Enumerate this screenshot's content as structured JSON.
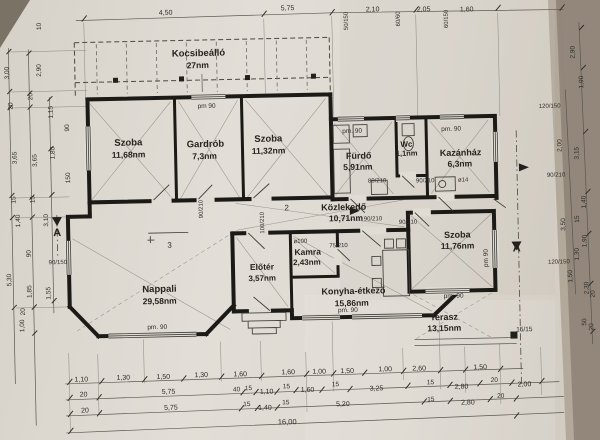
{
  "drawing_title": "floor plan photo",
  "rooms": [
    {
      "name": "Kocsibeálló",
      "area": "27nm"
    },
    {
      "name": "Szoba",
      "area": "11,68nm"
    },
    {
      "name": "Gardrób",
      "area": "7,3nm"
    },
    {
      "name": "Szoba",
      "area": "11,32nm"
    },
    {
      "name": "Fürdő",
      "area": "5,91nm"
    },
    {
      "name": "Wc",
      "area": "1,1nm"
    },
    {
      "name": "Kazánház",
      "area": "6,3nm"
    },
    {
      "name": "Közlekedő",
      "area": "10,71nm"
    },
    {
      "name": "Kamra",
      "area": "2,43nm"
    },
    {
      "name": "Előtér",
      "area": "3,57nm"
    },
    {
      "name": "Nappali",
      "area": "29,58nm"
    },
    {
      "name": "Konyha-étkező",
      "area": "15,86nm"
    },
    {
      "name": "Szoba",
      "area": "11,76nm"
    },
    {
      "name": "Terasz",
      "area": "13,15nm"
    }
  ],
  "dims": {
    "top": [
      "4,50",
      "5,75",
      "2,10",
      "2,05",
      "1,60"
    ],
    "top_window_specs": [
      "50/150",
      "60/60",
      "60/150"
    ],
    "bottom_row1": [
      "1,10",
      "1,30",
      "1,50",
      "1,30",
      "1,60",
      "1,60",
      "1,00",
      "1,50",
      "1,00",
      "2,60",
      "1,50"
    ],
    "bottom_row2": [
      "20",
      "5,75",
      "40",
      "15",
      "1,10",
      "15",
      "1,60",
      "15",
      "3,25",
      "15",
      "2,80",
      "20",
      "2,00"
    ],
    "bottom_row3": [
      "20",
      "5,75",
      "15",
      "1,40",
      "15",
      "5,20",
      "15",
      "2,80",
      "20"
    ],
    "bottom_total": "16,00",
    "left": [
      "10",
      "3,00",
      "2,90",
      "20",
      "20",
      "1,15",
      "90",
      "3,65",
      "3,65",
      "1,80",
      "150",
      "15",
      "15",
      "1,40",
      "3,10",
      "90",
      "90/150",
      "5,30",
      "1,85",
      "1,55",
      "20",
      "1,00"
    ],
    "right": [
      "2,90",
      "1,90",
      "120/150",
      "2,00",
      "3,15",
      "90/210",
      "1,40",
      "15",
      "3,50",
      "1,90",
      "1,30",
      "120/150",
      "1,50",
      "2,30",
      "20",
      "50",
      "20"
    ]
  },
  "labels": [
    {
      "t": "Kocsibeálló",
      "x": 202,
      "y": 54,
      "s": 9.5,
      "b": 1,
      "n": "room-name-kocsibeallo"
    },
    {
      "t": "27nm",
      "x": 201,
      "y": 66,
      "s": 8.5,
      "b": 1,
      "n": "room-area-kocsibeallo"
    },
    {
      "t": "Szoba",
      "x": 130,
      "y": 142,
      "s": 9.5,
      "b": 1,
      "n": "room-name-szoba-1"
    },
    {
      "t": "11,68nm",
      "x": 130,
      "y": 154,
      "s": 8.5,
      "b": 1,
      "n": "room-area-szoba-1"
    },
    {
      "t": "Gardrób",
      "x": 207,
      "y": 145,
      "s": 9.5,
      "b": 1,
      "n": "room-name-gardrob"
    },
    {
      "t": "7,3nm",
      "x": 206,
      "y": 157,
      "s": 8.5,
      "b": 1,
      "n": "room-area-gardrob"
    },
    {
      "t": "Szoba",
      "x": 270,
      "y": 141,
      "s": 9.5,
      "b": 1,
      "n": "room-name-szoba-2"
    },
    {
      "t": "11,32nm",
      "x": 270,
      "y": 153,
      "s": 8.5,
      "b": 1,
      "n": "room-area-szoba-2"
    },
    {
      "t": "Fürdő",
      "x": 360,
      "y": 160,
      "s": 9,
      "b": 1,
      "n": "room-name-furdo"
    },
    {
      "t": "5,91nm",
      "x": 359,
      "y": 171,
      "s": 8.5,
      "b": 1,
      "n": "room-area-furdo"
    },
    {
      "t": "Wc",
      "x": 408,
      "y": 149,
      "s": 8,
      "b": 1,
      "n": "room-name-wc"
    },
    {
      "t": "1,1nm",
      "x": 408,
      "y": 158,
      "s": 7.5,
      "b": 1,
      "n": "room-area-wc"
    },
    {
      "t": "Kazánház",
      "x": 462,
      "y": 159,
      "s": 9,
      "b": 1,
      "n": "room-name-kazanhaz"
    },
    {
      "t": "6,3nm",
      "x": 461,
      "y": 170,
      "s": 8.5,
      "b": 1,
      "n": "room-area-kazanhaz"
    },
    {
      "t": "Közlekedő",
      "x": 344,
      "y": 211,
      "s": 9,
      "b": 1,
      "n": "room-name-kozlekedo"
    },
    {
      "t": "10,71nm",
      "x": 346,
      "y": 222,
      "s": 8.5,
      "b": 1,
      "n": "room-area-kozlekedo"
    },
    {
      "t": "Kamra",
      "x": 307,
      "y": 255,
      "s": 8.5,
      "b": 1,
      "n": "room-name-kamra"
    },
    {
      "t": "2,43nm",
      "x": 306,
      "y": 265,
      "s": 8,
      "b": 1,
      "n": "room-area-kamra"
    },
    {
      "t": "Előtér",
      "x": 261,
      "y": 269,
      "s": 8.5,
      "b": 1,
      "n": "room-name-eloter"
    },
    {
      "t": "3,57nm",
      "x": 261,
      "y": 280,
      "s": 8,
      "b": 1,
      "n": "room-area-eloter"
    },
    {
      "t": "Nappali",
      "x": 158,
      "y": 289,
      "s": 9.5,
      "b": 1,
      "n": "room-name-nappali"
    },
    {
      "t": "29,58nm",
      "x": 158,
      "y": 301,
      "s": 8.5,
      "b": 1,
      "n": "room-area-nappali"
    },
    {
      "t": "Konyha-étkező",
      "x": 352,
      "y": 295,
      "s": 9,
      "b": 1,
      "n": "room-name-konyha"
    },
    {
      "t": "15,86nm",
      "x": 350,
      "y": 307,
      "s": 8.5,
      "b": 1,
      "n": "room-area-konyha"
    },
    {
      "t": "Szoba",
      "x": 457,
      "y": 241,
      "s": 9,
      "b": 1,
      "n": "room-name-szoba-3"
    },
    {
      "t": "11,76nm",
      "x": 457,
      "y": 252,
      "s": 8.5,
      "b": 1,
      "n": "room-area-szoba-3"
    },
    {
      "t": "Terasz",
      "x": 442,
      "y": 323,
      "s": 9,
      "b": 1,
      "n": "room-name-terasz"
    },
    {
      "t": "13,15nm",
      "x": 442,
      "y": 334,
      "s": 8.5,
      "b": 1,
      "n": "room-area-terasz"
    },
    {
      "t": "2",
      "x": 287,
      "y": 210,
      "s": 8,
      "n": "room-number-2"
    },
    {
      "t": "3",
      "x": 169,
      "y": 245,
      "s": 8,
      "n": "room-number-3"
    },
    {
      "t": "A",
      "x": 57,
      "y": 231,
      "s": 11,
      "b": 1,
      "n": "section-marker-a-left"
    },
    {
      "t": "A",
      "x": 516,
      "y": 256,
      "s": 11,
      "b": 1,
      "n": "section-marker-a-right"
    },
    {
      "t": "15/15",
      "x": 522,
      "y": 336,
      "s": 6.5,
      "n": "post-size-label"
    },
    {
      "t": "pm 90",
      "x": 209,
      "y": 106,
      "n": "window-parapet-label"
    },
    {
      "t": "pm. 90",
      "x": 354,
      "y": 134,
      "n": "window-parapet-label"
    },
    {
      "t": "pm. 90",
      "x": 453,
      "y": 134,
      "n": "window-parapet-label"
    },
    {
      "t": "pm. 90",
      "x": 155,
      "y": 326,
      "n": "window-parapet-label"
    },
    {
      "t": "pm. 90",
      "x": 346,
      "y": 313,
      "n": "window-parapet-label"
    },
    {
      "t": "pm. 90",
      "x": 452,
      "y": 301,
      "n": "window-parapet-label"
    },
    {
      "t": "pm 90",
      "x": 487,
      "y": 262,
      "r": -90,
      "n": "window-parapet-label"
    },
    {
      "t": "80/210",
      "x": 378,
      "y": 184,
      "s": 6,
      "n": "door-size-label"
    },
    {
      "t": "90/210",
      "x": 426,
      "y": 185,
      "s": 6,
      "n": "door-size-label"
    },
    {
      "t": "90/210",
      "x": 203,
      "y": 207,
      "r": -90,
      "s": 6,
      "n": "door-size-label"
    },
    {
      "t": "100/210",
      "x": 264,
      "y": 222,
      "r": -90,
      "s": 6,
      "n": "door-size-label"
    },
    {
      "t": "90/210",
      "x": 373,
      "y": 222,
      "s": 6,
      "n": "door-size-label"
    },
    {
      "t": "90/210",
      "x": 408,
      "y": 226,
      "s": 6,
      "n": "door-size-label"
    },
    {
      "t": "75/210",
      "x": 338,
      "y": 248,
      "s": 6,
      "n": "door-size-label"
    },
    {
      "t": "ø100",
      "x": 300,
      "y": 243,
      "s": 6,
      "n": "vent-label"
    },
    {
      "t": "ø14",
      "x": 464,
      "y": 185,
      "s": 6,
      "n": "flue-label"
    },
    {
      "t": "90/150",
      "x": 57,
      "y": 259,
      "s": 6,
      "n": "window-size-label"
    },
    {
      "t": "120/150",
      "x": 552,
      "y": 113,
      "s": 6,
      "n": "window-size-label"
    },
    {
      "t": "120/150",
      "x": 558,
      "y": 269,
      "s": 6,
      "n": "window-size-label"
    },
    {
      "t": "90/210",
      "x": 557,
      "y": 182,
      "s": 6,
      "n": "door-size-label"
    },
    {
      "t": "50/150",
      "x": 352,
      "y": 22,
      "r": -90,
      "s": 6,
      "n": "window-size-label"
    },
    {
      "t": "60/60",
      "x": 404,
      "y": 21,
      "r": -90,
      "s": 6,
      "n": "window-size-label"
    },
    {
      "t": "60/150",
      "x": 452,
      "y": 22,
      "r": -90,
      "s": 6,
      "n": "window-size-label"
    },
    {
      "t": "4,50",
      "x": 170,
      "y": 12,
      "s": 7,
      "n": "dim-top"
    },
    {
      "t": "5,75",
      "x": 292,
      "y": 10,
      "s": 7,
      "n": "dim-top"
    },
    {
      "t": "2,10",
      "x": 377,
      "y": 13,
      "s": 7,
      "n": "dim-top"
    },
    {
      "t": "2,05",
      "x": 428,
      "y": 14,
      "s": 7,
      "n": "dim-top"
    },
    {
      "t": "1,60",
      "x": 471,
      "y": 15,
      "s": 7,
      "n": "dim-top"
    },
    {
      "t": "10",
      "x": 45,
      "y": 21,
      "r": -90,
      "n": "dim-left"
    },
    {
      "t": "3,00",
      "x": 12,
      "y": 67,
      "r": -90,
      "n": "dim-left"
    },
    {
      "t": "2,90",
      "x": 44,
      "y": 65,
      "r": -90,
      "n": "dim-left"
    },
    {
      "t": "20",
      "x": 35,
      "y": 91,
      "r": -90,
      "n": "dim-left"
    },
    {
      "t": "20",
      "x": 15,
      "y": 100,
      "r": -90,
      "n": "dim-left"
    },
    {
      "t": "1,15",
      "x": 55,
      "y": 107,
      "r": -90,
      "n": "dim-left"
    },
    {
      "t": "90",
      "x": 71,
      "y": 123,
      "r": -90,
      "n": "dim-left"
    },
    {
      "t": "3,65",
      "x": 18,
      "y": 152,
      "r": -90,
      "n": "dim-left"
    },
    {
      "t": "3,65",
      "x": 38,
      "y": 155,
      "r": -90,
      "n": "dim-left"
    },
    {
      "t": "1,80",
      "x": 56,
      "y": 148,
      "r": -90,
      "n": "dim-left"
    },
    {
      "t": "150",
      "x": 71,
      "y": 173,
      "r": -90,
      "n": "dim-left"
    },
    {
      "t": "15",
      "x": 16,
      "y": 194,
      "r": -90,
      "n": "dim-left"
    },
    {
      "t": "15",
      "x": 35,
      "y": 194,
      "r": -90,
      "n": "dim-left"
    },
    {
      "t": "1,40",
      "x": 20,
      "y": 215,
      "r": -90,
      "n": "dim-left"
    },
    {
      "t": "3,10",
      "x": 48,
      "y": 215,
      "r": -90,
      "n": "dim-left"
    },
    {
      "t": "90",
      "x": 30,
      "y": 248,
      "r": -90,
      "n": "dim-left"
    },
    {
      "t": "5,30",
      "x": 10,
      "y": 274,
      "r": -90,
      "n": "dim-left"
    },
    {
      "t": "1,85",
      "x": 30,
      "y": 286,
      "r": -90,
      "n": "dim-left"
    },
    {
      "t": "1,55",
      "x": 49,
      "y": 288,
      "r": -90,
      "n": "dim-left"
    },
    {
      "t": "20",
      "x": 23,
      "y": 306,
      "r": -90,
      "n": "dim-left"
    },
    {
      "t": "1,00",
      "x": 22,
      "y": 320,
      "r": -90,
      "n": "dim-left"
    },
    {
      "t": "2,90",
      "x": 578,
      "y": 58,
      "r": -90,
      "n": "dim-right"
    },
    {
      "t": "1,90",
      "x": 586,
      "y": 88,
      "r": -90,
      "n": "dim-right"
    },
    {
      "t": "2,00",
      "x": 563,
      "y": 151,
      "r": -90,
      "n": "dim-right"
    },
    {
      "t": "3,15",
      "x": 580,
      "y": 159,
      "r": -90,
      "n": "dim-right"
    },
    {
      "t": "1,40",
      "x": 586,
      "y": 208,
      "r": -90,
      "n": "dim-right"
    },
    {
      "t": "15",
      "x": 579,
      "y": 225,
      "r": -90,
      "n": "dim-right"
    },
    {
      "t": "3,50",
      "x": 565,
      "y": 230,
      "r": -90,
      "n": "dim-right"
    },
    {
      "t": "1,90",
      "x": 586,
      "y": 247,
      "r": -90,
      "n": "dim-right"
    },
    {
      "t": "1,30",
      "x": 578,
      "y": 260,
      "r": -90,
      "n": "dim-right"
    },
    {
      "t": "1,50",
      "x": 571,
      "y": 282,
      "r": -90,
      "n": "dim-right"
    },
    {
      "t": "2,30",
      "x": 587,
      "y": 294,
      "r": -90,
      "n": "dim-right"
    },
    {
      "t": "20",
      "x": 593,
      "y": 300,
      "r": -90,
      "n": "dim-right"
    },
    {
      "t": "50",
      "x": 584,
      "y": 328,
      "r": -90,
      "n": "dim-right"
    },
    {
      "t": "20",
      "x": 591,
      "y": 333,
      "r": -90,
      "n": "dim-right"
    },
    {
      "t": "1,10",
      "x": 78,
      "y": 377,
      "s": 7,
      "n": "dim-bottom"
    },
    {
      "t": "1,30",
      "x": 120,
      "y": 376,
      "s": 7,
      "n": "dim-bottom"
    },
    {
      "t": "1,50",
      "x": 160,
      "y": 376,
      "s": 7,
      "n": "dim-bottom"
    },
    {
      "t": "1,30",
      "x": 198,
      "y": 375,
      "s": 7,
      "n": "dim-bottom"
    },
    {
      "t": "1,60",
      "x": 237,
      "y": 375,
      "s": 7,
      "n": "dim-bottom"
    },
    {
      "t": "1,60",
      "x": 285,
      "y": 374,
      "s": 7,
      "n": "dim-bottom"
    },
    {
      "t": "1,00",
      "x": 316,
      "y": 374,
      "s": 7,
      "n": "dim-bottom"
    },
    {
      "t": "1,50",
      "x": 344,
      "y": 374,
      "s": 7,
      "n": "dim-bottom"
    },
    {
      "t": "1,00",
      "x": 382,
      "y": 373,
      "s": 7,
      "n": "dim-bottom"
    },
    {
      "t": "2,60",
      "x": 416,
      "y": 373,
      "s": 7,
      "n": "dim-bottom"
    },
    {
      "t": "1,50",
      "x": 477,
      "y": 373,
      "s": 7,
      "n": "dim-bottom"
    },
    {
      "t": "20",
      "x": 80,
      "y": 392,
      "s": 7,
      "n": "dim-bottom"
    },
    {
      "t": "5,75",
      "x": 165,
      "y": 391,
      "s": 7,
      "n": "dim-bottom"
    },
    {
      "t": "40",
      "x": 233,
      "y": 390,
      "s": 6.5,
      "n": "dim-bottom"
    },
    {
      "t": "15",
      "x": 245,
      "y": 389,
      "s": 6.5,
      "n": "dim-bottom"
    },
    {
      "t": "1,10",
      "x": 263,
      "y": 393,
      "s": 7,
      "n": "dim-bottom"
    },
    {
      "t": "15",
      "x": 283,
      "y": 388,
      "s": 6.5,
      "n": "dim-bottom"
    },
    {
      "t": "1,60",
      "x": 304,
      "y": 392,
      "s": 7,
      "n": "dim-bottom"
    },
    {
      "t": "15",
      "x": 332,
      "y": 387,
      "s": 6.5,
      "n": "dim-bottom"
    },
    {
      "t": "3,25",
      "x": 373,
      "y": 392,
      "s": 7,
      "n": "dim-bottom"
    },
    {
      "t": "15",
      "x": 427,
      "y": 387,
      "s": 6.5,
      "n": "dim-bottom"
    },
    {
      "t": "2,80",
      "x": 458,
      "y": 392,
      "s": 7,
      "n": "dim-bottom"
    },
    {
      "t": "20",
      "x": 491,
      "y": 386,
      "s": 6.5,
      "n": "dim-bottom"
    },
    {
      "t": "2,00",
      "x": 521,
      "y": 391,
      "s": 7,
      "n": "dim-bottom"
    },
    {
      "t": "20",
      "x": 81,
      "y": 408,
      "s": 7,
      "n": "dim-bottom"
    },
    {
      "t": "5,75",
      "x": 167,
      "y": 407,
      "s": 7,
      "n": "dim-bottom"
    },
    {
      "t": "15",
      "x": 243,
      "y": 405,
      "s": 6.5,
      "n": "dim-bottom"
    },
    {
      "t": "1,40",
      "x": 261,
      "y": 409,
      "s": 7,
      "n": "dim-bottom"
    },
    {
      "t": "15",
      "x": 282,
      "y": 404,
      "s": 6.5,
      "n": "dim-bottom"
    },
    {
      "t": "5,20",
      "x": 339,
      "y": 407,
      "s": 7,
      "n": "dim-bottom"
    },
    {
      "t": "15",
      "x": 427,
      "y": 404,
      "s": 6.5,
      "n": "dim-bottom"
    },
    {
      "t": "2,80",
      "x": 464,
      "y": 408,
      "s": 7,
      "n": "dim-bottom"
    },
    {
      "t": "20",
      "x": 497,
      "y": 402,
      "s": 6.5,
      "n": "dim-bottom"
    },
    {
      "t": "16,00",
      "x": 283,
      "y": 424,
      "s": 7.5,
      "n": "dim-bottom-total"
    }
  ]
}
